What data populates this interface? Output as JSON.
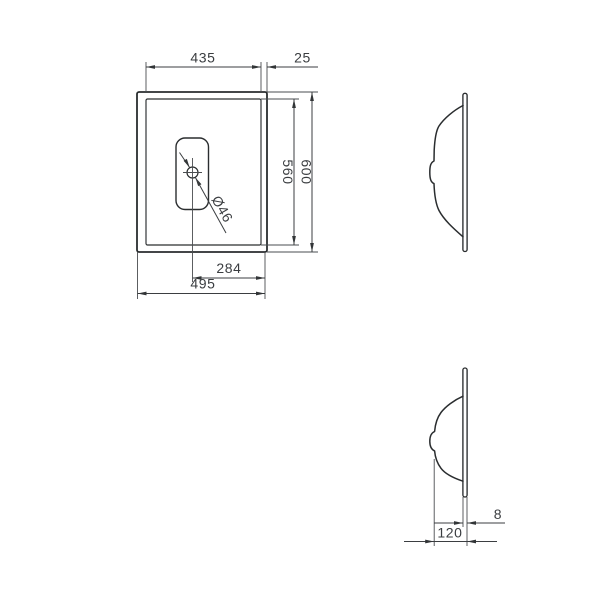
{
  "drawing": {
    "type": "washbasin-dimension-drawing",
    "units": "mm",
    "colors": {
      "background": "#ffffff",
      "outline": "#2a2d2f",
      "dimension_lines": "#3b3e41",
      "dimension_text": "#3a3d40"
    },
    "plan_view": {
      "dim_inner_width": "435",
      "dim_right_flange": "25",
      "dim_inner_depth": "560",
      "dim_outer_depth": "600",
      "dim_drain_to_edge": "284",
      "dim_outer_width": "495",
      "dim_drain_diameter": "Ø46"
    },
    "profile_view": {
      "dim_flange_thickness": "8",
      "dim_bowl_depth": "120"
    }
  }
}
